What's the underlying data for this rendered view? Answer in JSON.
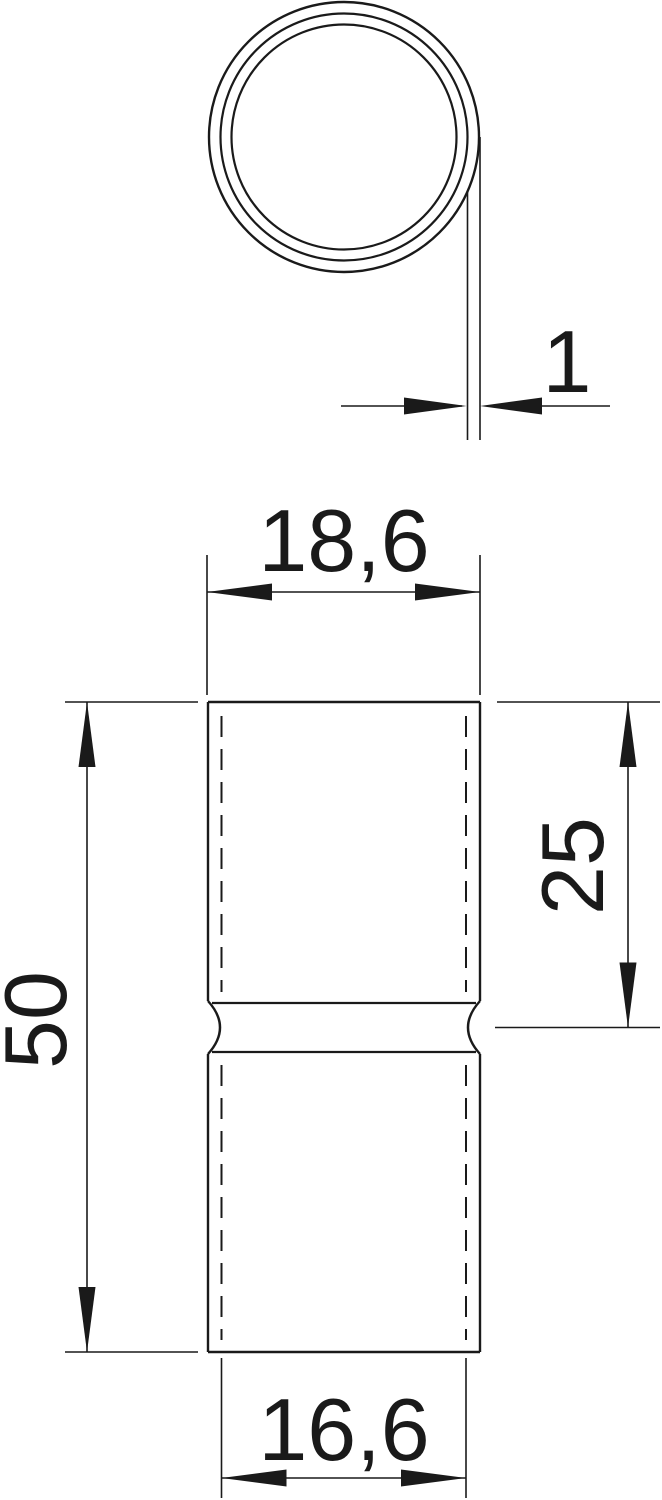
{
  "drawing": {
    "colors": {
      "background": "#ffffff",
      "line": "#1a1a1a"
    },
    "views": {
      "top_view_name": "tube-cross-section",
      "front_view_name": "sleeve-front-view"
    },
    "dimensions": {
      "wall_thickness": "1",
      "outer_diameter": "18,6",
      "overall_length": "50",
      "socket_depth": "25",
      "inner_diameter": "16,6"
    }
  }
}
